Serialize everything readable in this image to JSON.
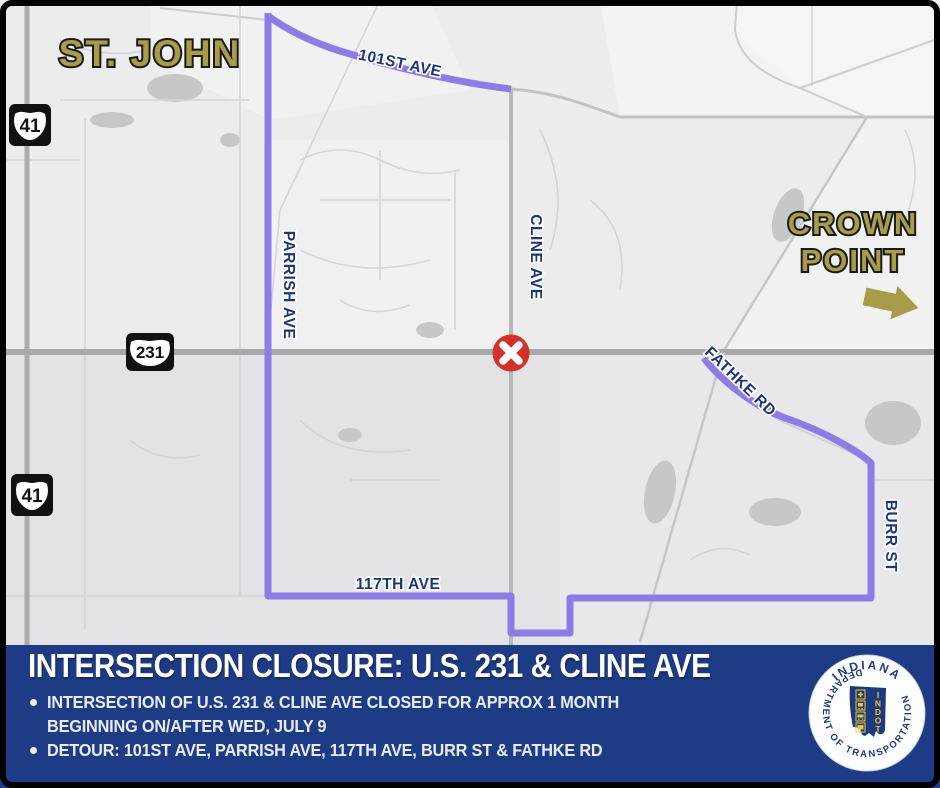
{
  "map": {
    "city_labels": {
      "st_john": "ST. JOHN",
      "crown_point_line1": "CROWN",
      "crown_point_line2": "POINT"
    },
    "road_labels": {
      "ave_101st": "101ST AVE",
      "parrish": "PARRISH AVE",
      "cline": "CLINE AVE",
      "fathke": "FATHKE RD",
      "burr": "BURR ST",
      "ave_117th": "117TH AVE"
    },
    "route_shields": {
      "us41": "41",
      "us231": "231"
    },
    "colors": {
      "detour_purple": "#8d7ce4",
      "closure_red": "#d3312b",
      "label_navy": "#1e3478",
      "city_olive": "#a89b4a",
      "banner_navy": "#1e3c86"
    }
  },
  "banner": {
    "title": "INTERSECTION CLOSURE: U.S. 231 & CLINE AVE",
    "bullet1_line1": "INTERSECTION OF U.S. 231 & CLINE AVE CLOSED FOR APPROX 1 MONTH",
    "bullet1_line2": "BEGINNING ON/AFTER WED, JULY 9",
    "bullet2": "DETOUR: 101ST AVE, PARRISH AVE, 117TH AVE, BURR ST & FATHKE RD"
  },
  "logo": {
    "arc_top": "INDIANA",
    "arc_bottom": "DEPARTMENT OF TRANSPORTATION",
    "acronym_letters": [
      "I",
      "N",
      "D",
      "O",
      "T"
    ]
  }
}
